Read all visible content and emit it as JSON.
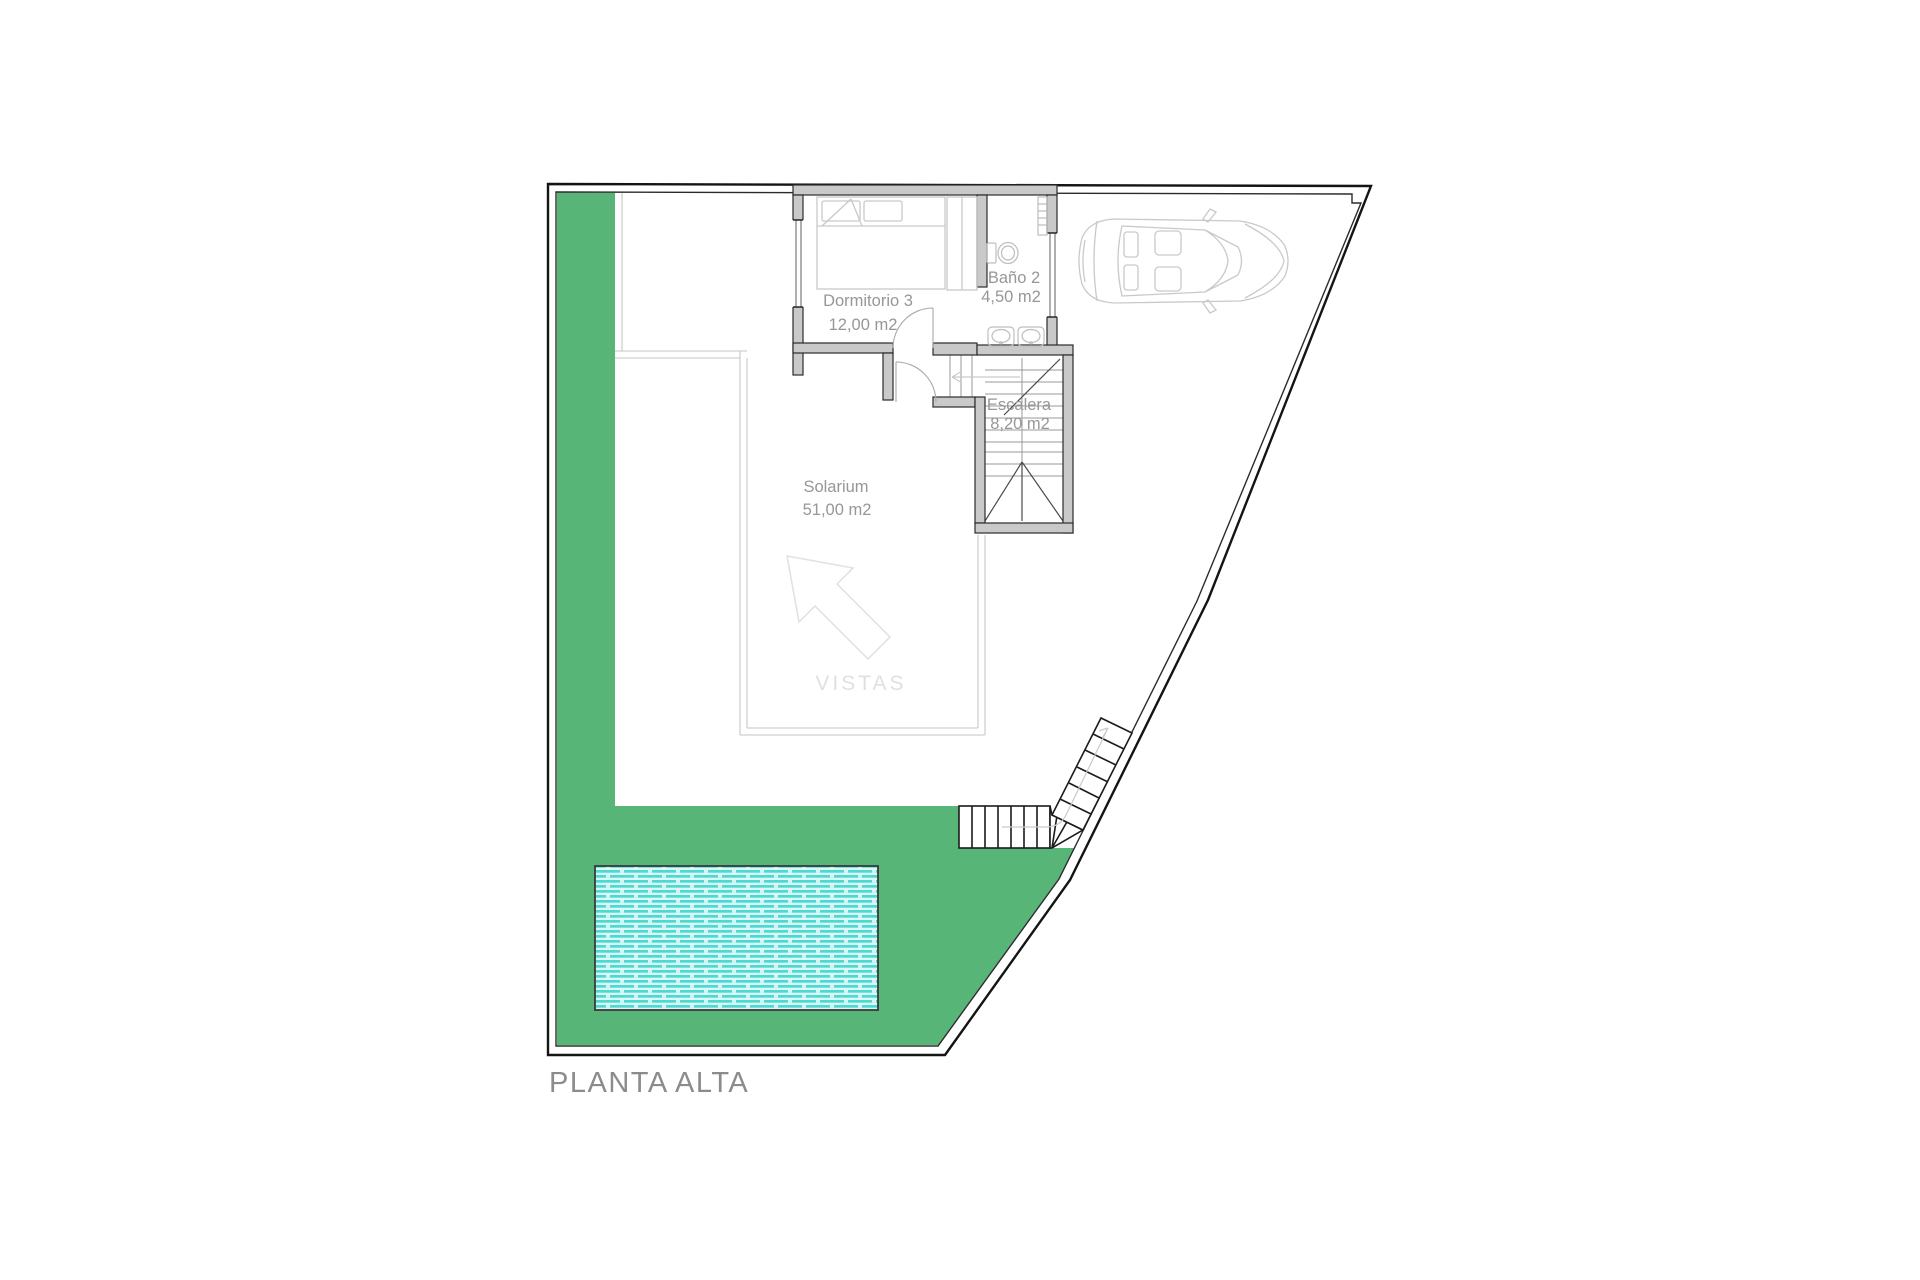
{
  "title": "PLANTA ALTA",
  "rooms": {
    "dormitorio": {
      "name": "Dormitorio 3",
      "area": "12,00 m2"
    },
    "bano": {
      "name": "Baño 2",
      "area": "4,50 m2"
    },
    "escalera": {
      "name": "Escalera",
      "area": "8,20 m2"
    },
    "solarium": {
      "name": "Solarium",
      "area": "51,00 m2"
    }
  },
  "annotations": {
    "vistas": "VISTAS"
  },
  "colors": {
    "garden": "#58b578",
    "pool_stripe": "#4ed8d2",
    "pool_light": "#dbf8f7",
    "wall_fill": "#c9c9c9"
  }
}
